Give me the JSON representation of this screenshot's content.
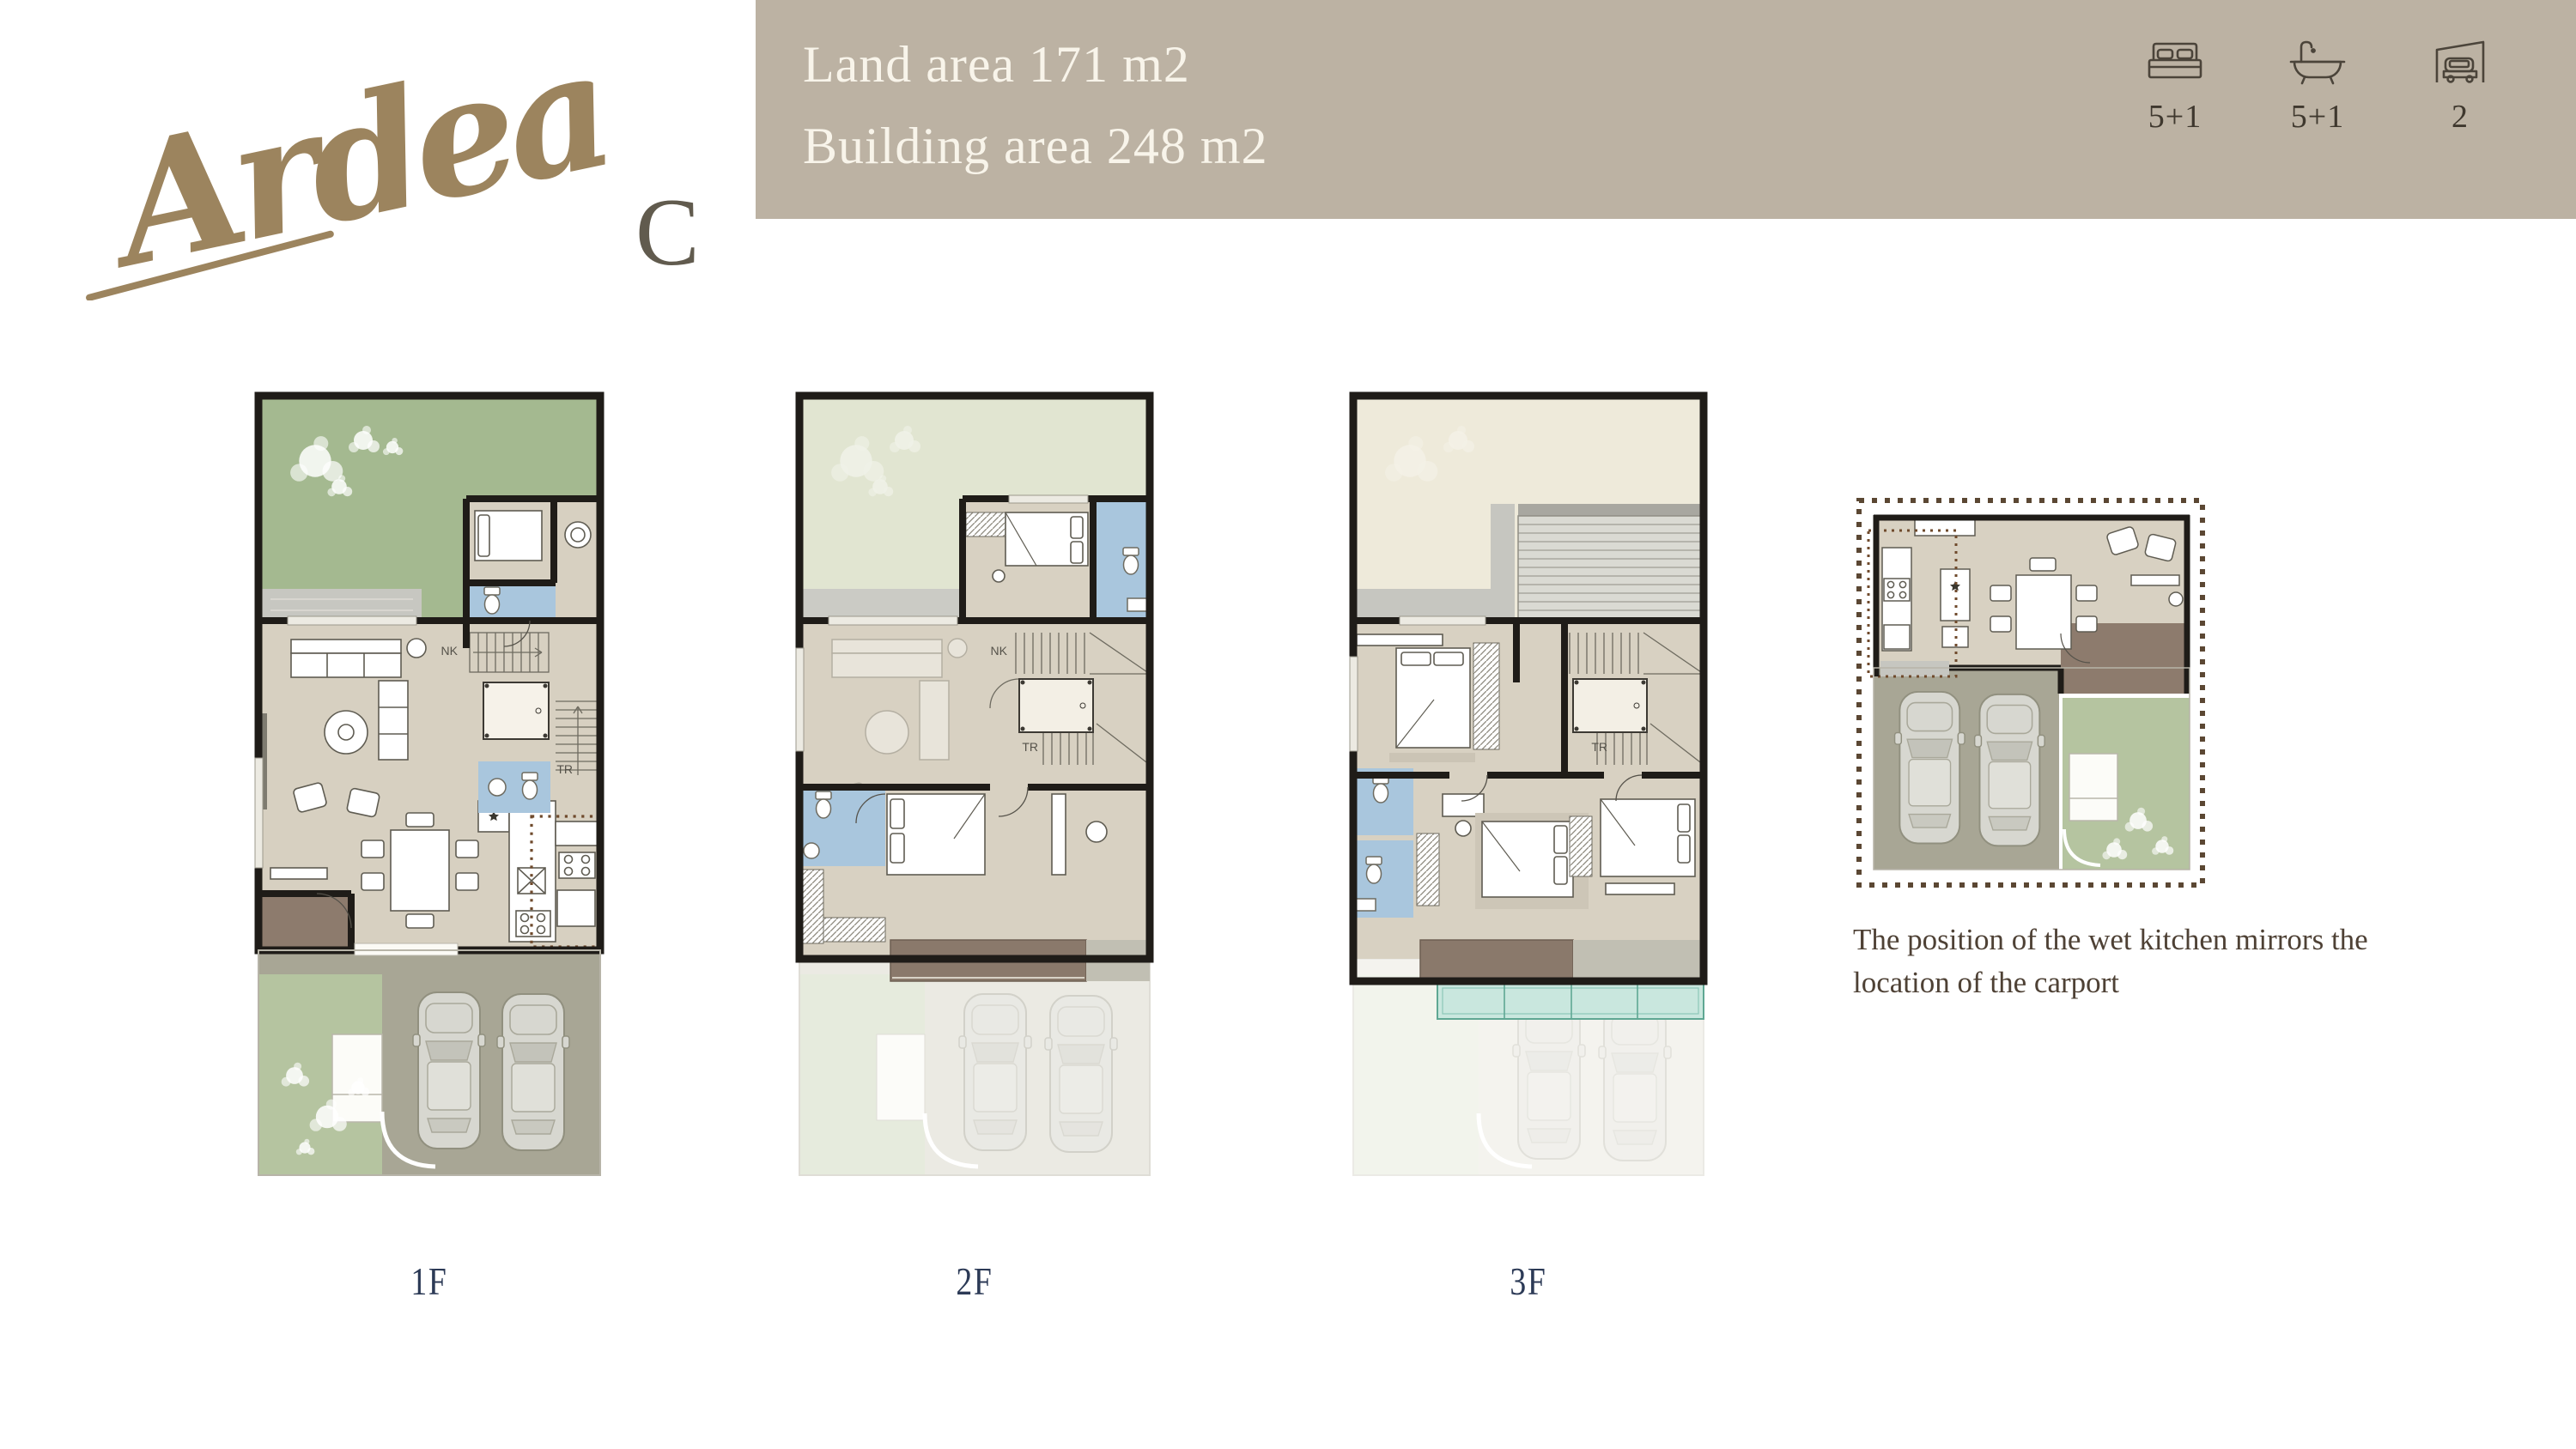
{
  "logo": {
    "name": "Ardea",
    "variant": "C"
  },
  "header": {
    "line1": "Land area 171 m2",
    "line2": "Building area 248 m2"
  },
  "stats": [
    {
      "icon": "bed-icon",
      "value": "5+1"
    },
    {
      "icon": "bath-icon",
      "value": "5+1"
    },
    {
      "icon": "carport-icon",
      "value": "2"
    }
  ],
  "floors": [
    {
      "label": "1F"
    },
    {
      "label": "2F"
    },
    {
      "label": "3F"
    }
  ],
  "plan_labels": {
    "nk": "NK",
    "tr": "TR"
  },
  "note": {
    "text": "The position of the wet kitchen mirrors the location of the carport"
  },
  "colors": {
    "header_band": "#bcb2a3",
    "header_text": "#f8f4ea",
    "logo_gold": "#9c845e",
    "logo_c": "#615b4e",
    "floor_label_navy": "#2c3a56",
    "note_brown": "#4e4135",
    "wall_black": "#1f1c18",
    "room_beige": "#d7d0c1",
    "garden_green": "#a4b990",
    "lawn_green": "#b5c4a0",
    "pale_green_2f": "#e1e5d1",
    "cream_3f": "#eeeada",
    "bath_blue": "#a9c6dd",
    "foyer_brown": "#8d7b6d",
    "balcony_brown": "#8a796b",
    "driveway_gray": "#a8a695",
    "deck_gray": "#c7c7c1",
    "canopy_teal": "#c9e7de",
    "dotted_border_brown": "#5b4733",
    "wet_kitchen_dots": "#6f4a2c"
  }
}
